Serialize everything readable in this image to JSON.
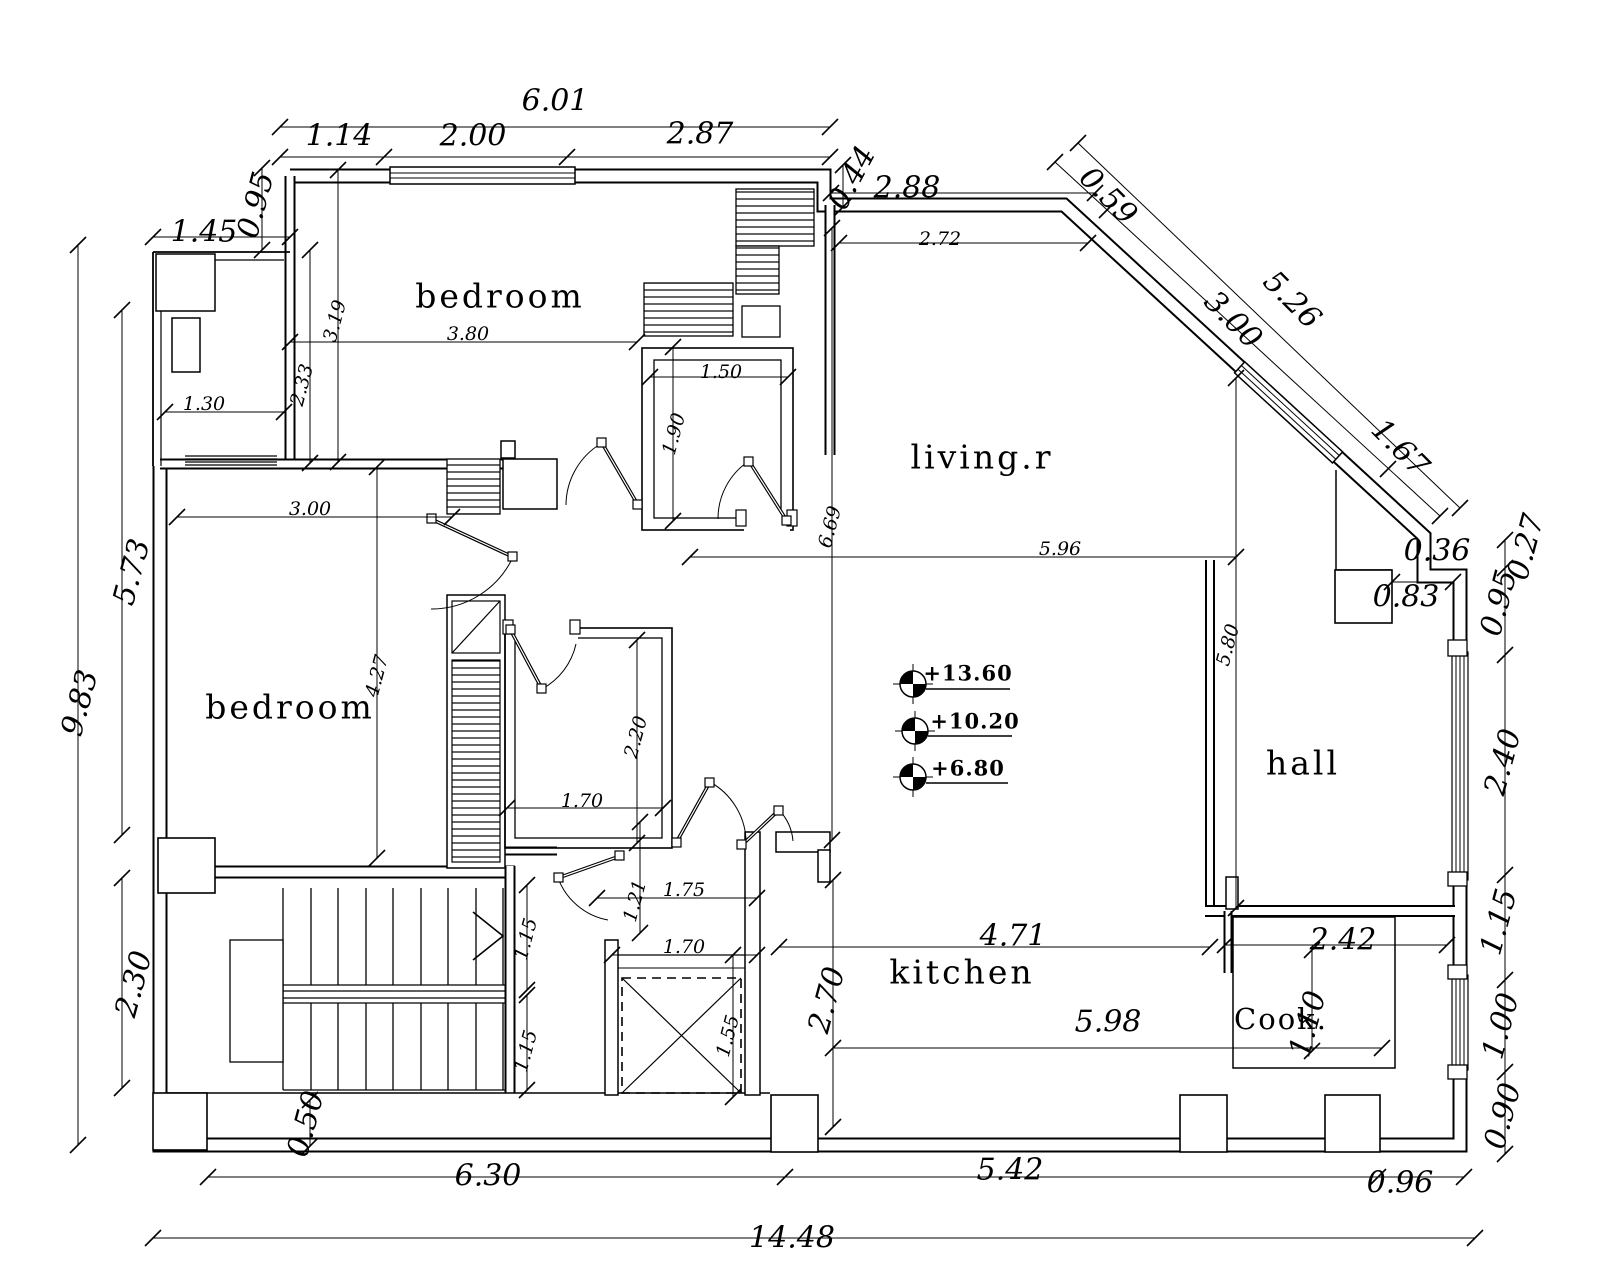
{
  "rooms": {
    "bedroom_top": "bedroom",
    "bedroom_left": "bedroom",
    "living": "living.r",
    "hall": "hall",
    "kitchen": "kitchen",
    "cook": "Cook."
  },
  "levels": {
    "l1": "+13.60",
    "l2": "+10.20",
    "l3": "+6.80"
  },
  "dims": {
    "top_total": "6.01",
    "top_a": "1.14",
    "top_b": "2.00",
    "top_c": "2.87",
    "balcony_offset": "1.45",
    "left_step": "0.95",
    "notch": "0.44",
    "living_top": "2.88",
    "living_top_in": "2.72",
    "diag_a": "0.59",
    "diag_b": "3.00",
    "diag_total": "5.26",
    "diag_c": "1.67",
    "step_036": "0.36",
    "step_083": "0.83",
    "right_027": "0.27",
    "right_095": "0.95",
    "right_240": "2.40",
    "right_115": "1.15",
    "right_100": "1.00",
    "right_090": "0.90",
    "bottom_096": "0.96",
    "bottom_542": "5.42",
    "bottom_630": "6.30",
    "bottom_total": "14.48",
    "left_total": "9.83",
    "left_a": "5.73",
    "left_b": "2.30",
    "bed1_w": "3.80",
    "bed1_h": "3.19",
    "balc_h": "2.33",
    "balc_w": "1.30",
    "bed2_w": "3.00",
    "bed2_h": "4.27",
    "wc1_w": "1.50",
    "wc1_h": "1.90",
    "wc2_h": "2.20",
    "wc2_w": "1.70",
    "corr_121": "1.21",
    "corr_175": "1.75",
    "corr_170": "1.70",
    "elev_155": "1.55",
    "stair_115a": "1.15",
    "stair_115b": "1.15",
    "stair_050": "0.50",
    "living_w": "5.96",
    "living_h": "6.69",
    "hall_h": "5.80",
    "kitchen_w": "4.71",
    "kitchen_h": "2.70",
    "kitchen_total": "5.98",
    "cook_w": "2.42",
    "cook_h": "1.10"
  }
}
